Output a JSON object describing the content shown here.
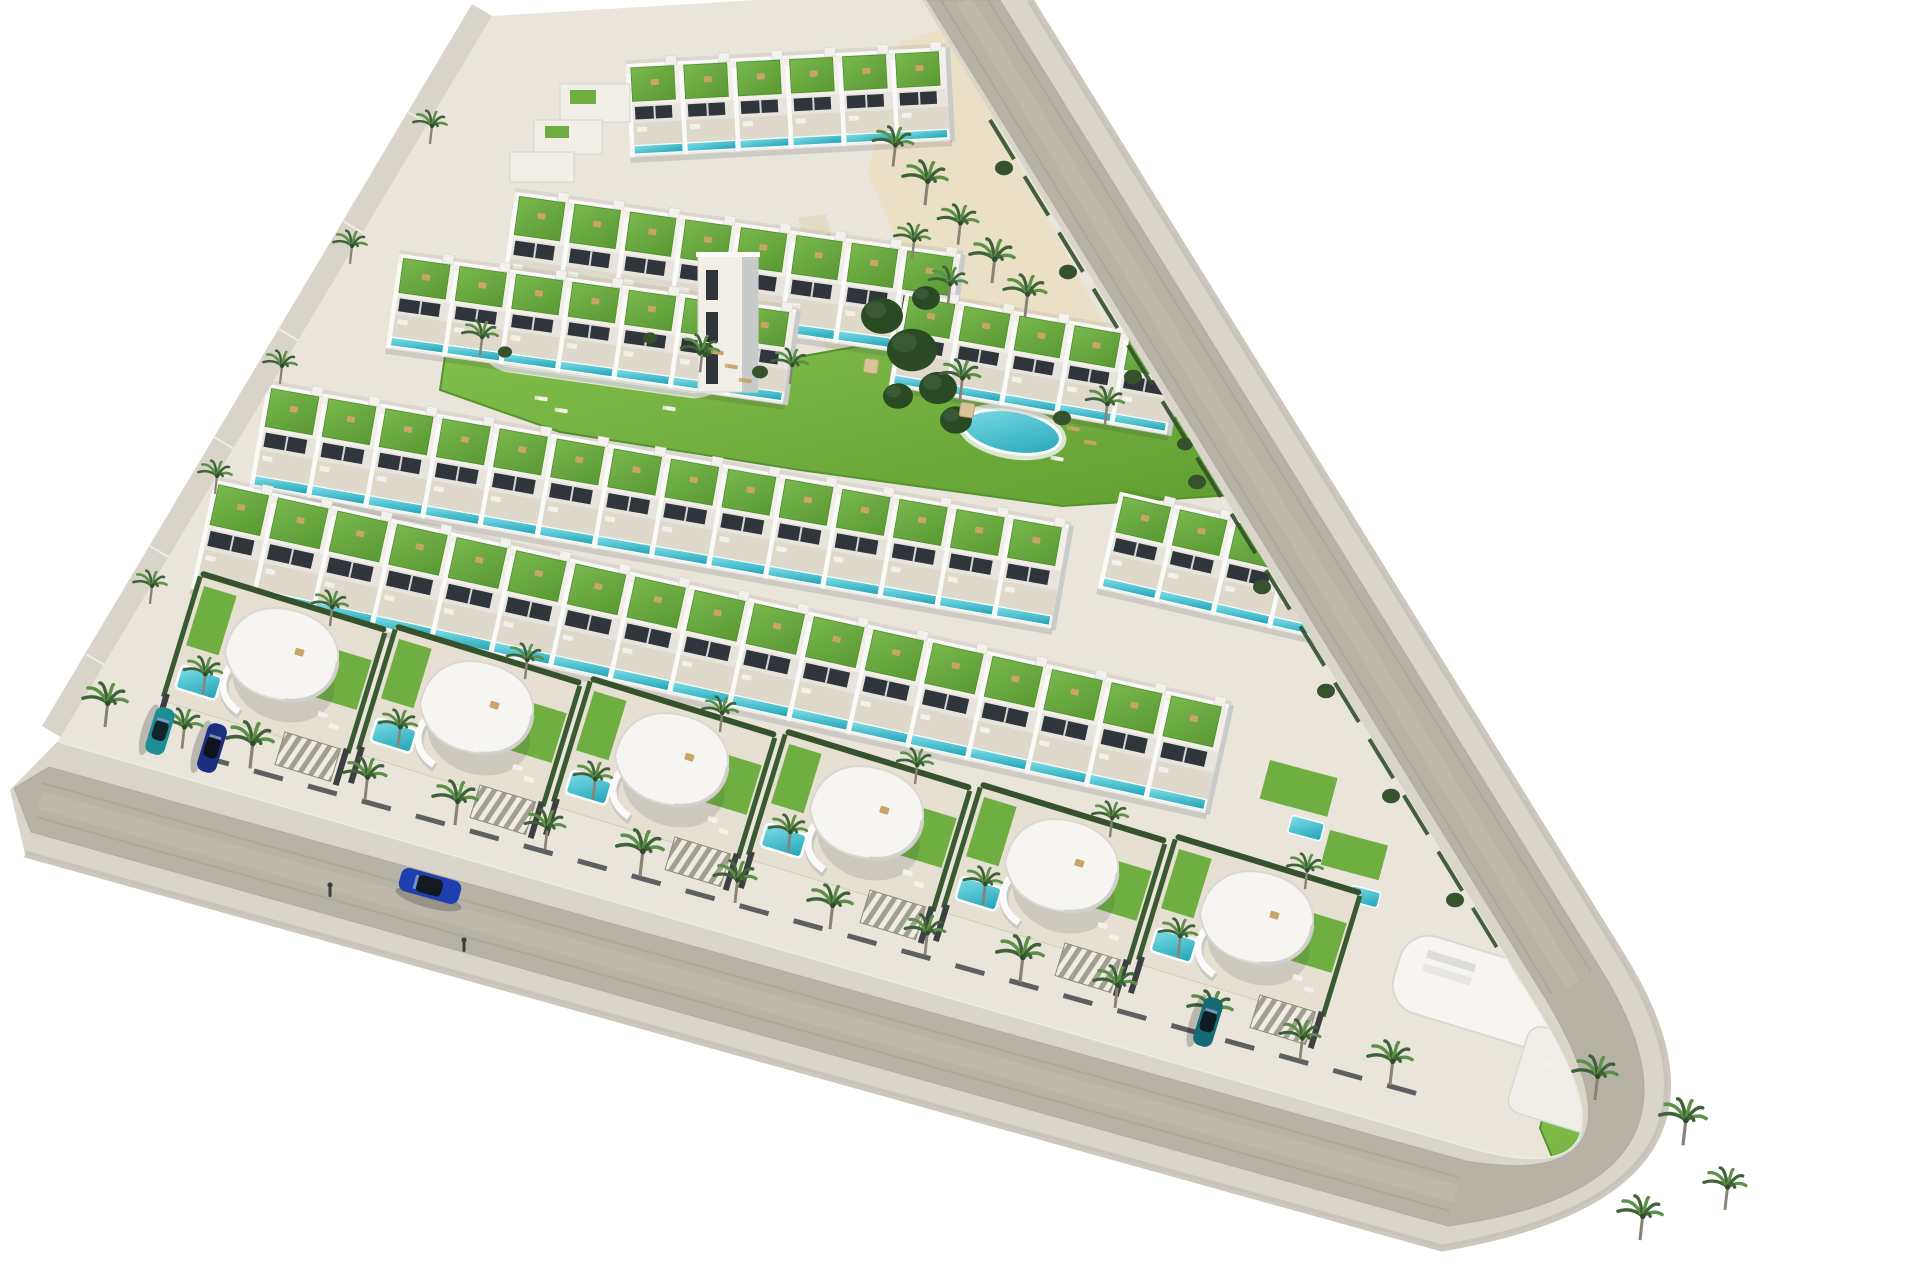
{
  "image": {
    "kind": "3d-aerial-architectural-render",
    "subject": "triangular coastal residential development with townhouse rows, communal pools and curved white villas bordered by two perimeter roads",
    "background": "#ffffff"
  },
  "colors": {
    "bg": "#ffffff",
    "asphalt": "#b7b2a6",
    "asphalt_wear": "#c6c1b4",
    "asphalt_joint": "#a49e91",
    "sidewalk": "#d9d5ca",
    "curb": "#efede6",
    "outer_edge": "#c6c2b7",
    "embankment": "#d8d4ca",
    "embankment_step": "#efece6",
    "site_base": "#e9e5db",
    "sand": "#e9e0c6",
    "walkway": "#e3dcc4",
    "walkway_step": "#cfc7a9",
    "building_white": "#f1efe8",
    "building_bright": "#fafaf8",
    "building_shade": "#c9cbca",
    "facade": "#e6e4dd",
    "window_dark": "#2f353b",
    "terrace": "#ded9cb",
    "villa_terrace": "#e6e0d2",
    "lawn_hi": "#83c04c",
    "lawn_lo": "#619e31",
    "roof_hi": "#79b84e",
    "roof_lo": "#5a9933",
    "roof_edge": "#4f8f2d",
    "pool_hi": "#7fdfe8",
    "pool_lo": "#1fa2b6",
    "pool_rim": "#fdfffe",
    "hedge": "#35522c",
    "tree_dark": "#2a4a24",
    "tree_mid": "#3c5c38",
    "palm_frond": "#3f6339",
    "palm_frond_light": "#5d9147",
    "palm_trunk": "#8a8274",
    "wall_dark": "#45484c",
    "furn_tan": "#c8a469",
    "furn_white": "#f2f0ea",
    "shadow": "rgba(60,65,75,0.16)",
    "person": "#3a3f45"
  },
  "roads": {
    "ring_d": "M1030,0 L1621,955 Q1770,1192 1442,1248 L25,854 L10,790 L58,741 L1470,1147 Q1653,1198 1536,1008 L916,0 Z",
    "asphalt_d": "M927,0 L1547,1001 Q1660,1193 1466,1161 L49,767 L14,788 L31,832 L1448,1226 Q1737,1186 1600,968 L1000,0 Z",
    "outer_edge_d": "M1030,0 L1621,955 Q1770,1192 1442,1248 L25,854",
    "curb_d": "M916,0 L1536,1008 Q1653,1198 1470,1147 L58,741",
    "wear": [
      {
        "d": "M964,0 L1573,985",
        "w": 16,
        "o": 0.4
      },
      {
        "d": "M40,800 L1456,1194",
        "w": 18,
        "o": 0.4
      }
    ],
    "joints": [
      {
        "d": "M941,0 L1552,994",
        "w": 2,
        "o": 0.5
      },
      {
        "d": "M988,0 L1591,972",
        "w": 2,
        "o": 0.5
      },
      {
        "d": "M42,783 L1458,1177",
        "w": 2,
        "o": 0.5
      },
      {
        "d": "M36,817 L1450,1211",
        "w": 2,
        "o": 0.5
      }
    ]
  },
  "embankment": {
    "points": "492,16 62,738 42,726 472,4",
    "steps": [
      [
        428,
        124,
        408,
        112
      ],
      [
        363,
        233,
        343,
        221
      ],
      [
        299,
        341,
        279,
        329
      ],
      [
        234,
        449,
        214,
        437
      ],
      [
        170,
        558,
        150,
        546
      ],
      [
        106,
        666,
        86,
        654
      ]
    ]
  },
  "site_clip_d": "M492,16 L916,-10 L1536,1008 Q1653,1198 1470,1147 L58,741 Z",
  "plaza_points": "900,42 945,28 1108,330 938,334 868,175",
  "walkway": {
    "points": [
      [
        798,
        218
      ],
      [
        826,
        214
      ],
      [
        880,
        440
      ],
      [
        848,
        446
      ]
    ],
    "steps": 11
  },
  "lawn_points": "450,322 770,362 905,338 1238,436 1282,492 1062,506 800,470 560,432 440,390",
  "pools": [
    {
      "name": "communal-pool-large",
      "kind": "stadium",
      "cx": 604,
      "cy": 350,
      "w": 240,
      "h": 57,
      "a": 8
    },
    {
      "name": "communal-pool-round",
      "kind": "ellipse",
      "cx": 1012,
      "cy": 432,
      "rx": 49,
      "ry": 21,
      "a": 10
    }
  ],
  "rows": [
    {
      "name": "townhouse-row-1",
      "x": 628,
      "y": 72,
      "a": -3,
      "u": 6,
      "w": 53,
      "d": 84
    },
    {
      "name": "townhouse-row-2",
      "x": 516,
      "y": 200,
      "a": 8,
      "u": 8,
      "w": 56,
      "d": 96
    },
    {
      "name": "townhouse-row-3",
      "x": 400,
      "y": 262,
      "a": 8,
      "u": 7,
      "w": 57,
      "d": 86
    },
    {
      "name": "townhouse-row-3-right",
      "x": 906,
      "y": 300,
      "a": 10,
      "u": 5,
      "w": 56,
      "d": 86
    },
    {
      "name": "townhouse-row-4",
      "x": 268,
      "y": 392,
      "a": 10,
      "u": 14,
      "w": 58,
      "d": 96
    },
    {
      "name": "townhouse-row-4-right",
      "x": 1120,
      "y": 500,
      "a": 13,
      "u": 4,
      "w": 58,
      "d": 90
    },
    {
      "name": "townhouse-row-5",
      "x": 215,
      "y": 488,
      "a": 12.5,
      "u": 17,
      "w": 61,
      "d": 102
    }
  ],
  "terrace_steps": [
    [
      560,
      84,
      70,
      38
    ],
    [
      534,
      120,
      68,
      34
    ],
    [
      510,
      152,
      64,
      30
    ]
  ],
  "step_greens": [
    [
      570,
      90,
      26,
      14
    ],
    [
      545,
      126,
      24,
      12
    ]
  ],
  "tower": {
    "x": 698,
    "y": 256,
    "w": 60,
    "h": 136
  },
  "villas": {
    "angle": 17,
    "centers": [
      [
        275,
        662
      ],
      [
        470,
        715
      ],
      [
        665,
        767
      ],
      [
        860,
        820
      ],
      [
        1055,
        873
      ],
      [
        1250,
        925
      ]
    ]
  },
  "patches": [
    [
      1270,
      760,
      70,
      40
    ],
    [
      1330,
      830,
      60,
      36
    ]
  ],
  "mini_pools": [
    [
      1292,
      815,
      34,
      18
    ],
    [
      1352,
      885,
      30,
      16
    ]
  ],
  "corner": {
    "cx": 1496,
    "cy": 1002,
    "a": 17,
    "garden_points": "1552,1082 1700,1126 1760,1206 1692,1250 1576,1214 1540,1128",
    "pool": {
      "cx": 1668,
      "cy": 1186,
      "w": 56,
      "h": 28
    }
  },
  "trees_dark": [
    [
      882,
      316,
      21
    ],
    [
      912,
      350,
      25
    ],
    [
      938,
      388,
      19
    ],
    [
      898,
      396,
      15
    ],
    [
      926,
      298,
      14
    ],
    [
      956,
      420,
      16
    ],
    [
      1135,
      270,
      18
    ],
    [
      1160,
      305,
      15
    ]
  ],
  "bushes": [
    [
      705,
      350,
      9
    ],
    [
      760,
      372,
      8
    ],
    [
      650,
      338,
      7
    ],
    [
      1062,
      418,
      9
    ],
    [
      1185,
      444,
      8
    ],
    [
      505,
      352,
      7
    ],
    [
      1004,
      168,
      9
    ],
    [
      1068,
      272,
      9
    ],
    [
      1133,
      377,
      9
    ],
    [
      1197,
      482,
      9
    ],
    [
      1262,
      587,
      9
    ],
    [
      1326,
      691,
      9
    ],
    [
      1391,
      796,
      9
    ],
    [
      1455,
      900,
      9
    ]
  ],
  "hedgerow": {
    "d": "M990,120 L1520,985",
    "w": 4,
    "dash": "46 20"
  },
  "wall_dash": {
    "d": "M200,756 L1440,1100",
    "w": 5,
    "dash": "30 26"
  },
  "loungers": [
    [
      714,
      350,
      8,
      "tan"
    ],
    [
      728,
      364,
      8,
      "tan"
    ],
    [
      742,
      378,
      8,
      "tan"
    ],
    [
      538,
      396,
      8,
      "white"
    ],
    [
      558,
      408,
      8,
      "white"
    ],
    [
      666,
      406,
      8,
      "white"
    ],
    [
      1070,
      426,
      10,
      "tan"
    ],
    [
      1087,
      440,
      10,
      "tan"
    ],
    [
      1054,
      456,
      10,
      "white"
    ],
    [
      955,
      272,
      10,
      "white"
    ]
  ],
  "parasols": [
    [
      871,
      366
    ],
    [
      967,
      410
    ]
  ],
  "palms": [
    [
      105,
      722,
      1
    ],
    [
      182,
      744,
      0.9
    ],
    [
      250,
      763,
      1.05
    ],
    [
      365,
      795,
      0.95
    ],
    [
      455,
      820,
      1
    ],
    [
      545,
      845,
      0.9
    ],
    [
      640,
      871,
      1.05
    ],
    [
      735,
      898,
      0.95
    ],
    [
      830,
      924,
      1
    ],
    [
      925,
      950,
      0.9
    ],
    [
      1020,
      977,
      1.05
    ],
    [
      1115,
      1003,
      0.95
    ],
    [
      1210,
      1030,
      1
    ],
    [
      1300,
      1055,
      0.9
    ],
    [
      1390,
      1080,
      1
    ],
    [
      203,
      690,
      0.85
    ],
    [
      330,
      622,
      0.8
    ],
    [
      398,
      743,
      0.85
    ],
    [
      525,
      675,
      0.8
    ],
    [
      593,
      795,
      0.85
    ],
    [
      720,
      728,
      0.8
    ],
    [
      788,
      848,
      0.85
    ],
    [
      915,
      780,
      0.8
    ],
    [
      983,
      900,
      0.85
    ],
    [
      1110,
      833,
      0.8
    ],
    [
      1178,
      952,
      0.85
    ],
    [
      1305,
      885,
      0.8
    ],
    [
      893,
      162,
      0.9
    ],
    [
      925,
      200,
      1
    ],
    [
      958,
      240,
      0.9
    ],
    [
      992,
      278,
      1
    ],
    [
      1025,
      312,
      0.95
    ],
    [
      948,
      300,
      0.85
    ],
    [
      912,
      255,
      0.8
    ],
    [
      480,
      352,
      0.8
    ],
    [
      700,
      368,
      0.85
    ],
    [
      790,
      380,
      0.8
    ],
    [
      960,
      395,
      0.9
    ],
    [
      1105,
      420,
      0.85
    ],
    [
      1595,
      1095,
      1
    ],
    [
      1683,
      1140,
      1.05
    ],
    [
      1725,
      1205,
      0.95
    ],
    [
      1640,
      1235,
      1
    ],
    [
      430,
      140,
      0.75
    ],
    [
      350,
      260,
      0.75
    ],
    [
      280,
      380,
      0.75
    ],
    [
      215,
      490,
      0.75
    ],
    [
      150,
      600,
      0.75
    ]
  ],
  "cars": [
    {
      "name": "car-blue-driving",
      "x": 430,
      "y": 886,
      "a": 15.5,
      "body": "#1e3fae",
      "cabin": "#141821",
      "L": 62,
      "W": 24
    },
    {
      "name": "car-teal-parked",
      "x": 160,
      "y": 731,
      "a": 107,
      "body": "#1d8e95",
      "cabin": "#10262b",
      "L": 48,
      "W": 20
    },
    {
      "name": "car-navy-parked",
      "x": 212,
      "y": 748,
      "a": 107,
      "body": "#1b2f80",
      "cabin": "#10141f",
      "L": 50,
      "W": 20
    },
    {
      "name": "car-darkteal-parked",
      "x": 1208,
      "y": 1022,
      "a": 107,
      "body": "#156a74",
      "cabin": "#0d1d22",
      "L": 50,
      "W": 20
    }
  ],
  "people": [
    [
      330,
      893
    ],
    [
      464,
      948
    ]
  ]
}
